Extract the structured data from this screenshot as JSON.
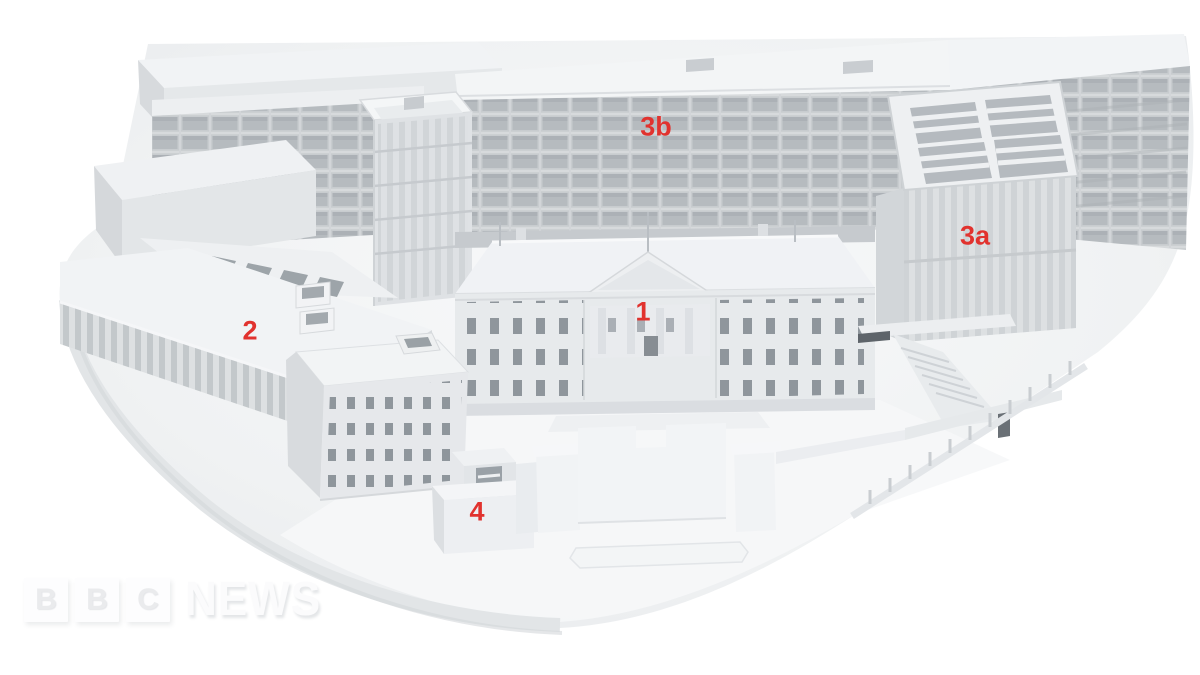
{
  "figure": {
    "title": "3D architectural model of a building complex, viewed from above, with numbered parts",
    "annotation_color": "#e1322e",
    "annotations": [
      {
        "id": "1",
        "text": "1"
      },
      {
        "id": "2",
        "text": "2"
      },
      {
        "id": "3a",
        "text": "3a"
      },
      {
        "id": "3b",
        "text": "3b"
      },
      {
        "id": "4",
        "text": "4"
      }
    ],
    "palette": {
      "background": "#ffffff",
      "model_light": "#f2f4f5",
      "model_mid": "#e6e9eb",
      "model_shade": "#d5d8db",
      "window_grid": "#b6bbbf",
      "window_dark": "#8f969c",
      "ground": "#f0f2f3"
    }
  },
  "watermark": {
    "box_letters": [
      "B",
      "B",
      "C"
    ],
    "wordmark": "NEWS"
  }
}
